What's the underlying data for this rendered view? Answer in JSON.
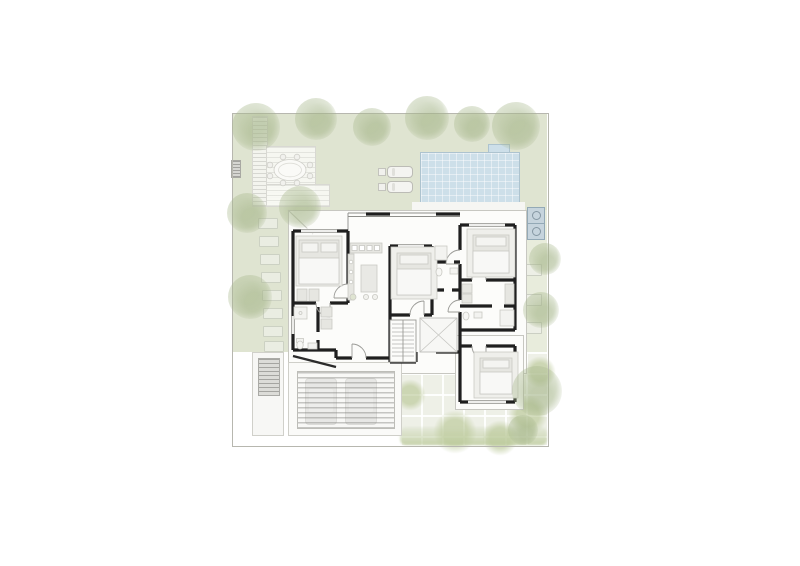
{
  "title": "villa-ground-floor-site-plan",
  "colors": {
    "page-bg": "#ffffff",
    "garden": "#dfe4d1",
    "garden-light": "#e8ecdc",
    "tree": "#a9b98e",
    "pool-fill": "#cddfe9",
    "pool-edge": "#adc3cf",
    "wall": "#1f1f1f",
    "roofline": "#c7c7c1",
    "floor": "#fcfcfa",
    "furniture": "#e6e6e1",
    "furniture-edge": "#c9c9c3",
    "deck": "#f3f4ee",
    "paving": "#eef0e7",
    "grass-patch": "#c9d5ae",
    "car": "#d6d6d2",
    "mat": "#b6b6b2",
    "ac-fill": "#c6d4dd",
    "ac-edge": "#93a9b6",
    "boundary": "#b7b7af",
    "glass": "#8e8e8a",
    "hedge": "#ccd7b6"
  },
  "site": {
    "trees": [
      {
        "x": 256,
        "y": 127,
        "r": 24
      },
      {
        "x": 316,
        "y": 119,
        "r": 21
      },
      {
        "x": 372,
        "y": 127,
        "r": 19
      },
      {
        "x": 427,
        "y": 118,
        "r": 22
      },
      {
        "x": 472,
        "y": 124,
        "r": 18
      },
      {
        "x": 516,
        "y": 126,
        "r": 24
      },
      {
        "x": 247,
        "y": 213,
        "r": 20
      },
      {
        "x": 250,
        "y": 297,
        "r": 22
      },
      {
        "x": 300,
        "y": 207,
        "r": 21
      },
      {
        "x": 545,
        "y": 259,
        "r": 16
      },
      {
        "x": 541,
        "y": 310,
        "r": 18
      },
      {
        "x": 537,
        "y": 391,
        "r": 25
      },
      {
        "x": 523,
        "y": 430,
        "r": 15
      }
    ],
    "left_pavers": [
      {
        "x": 258,
        "y": 218
      },
      {
        "x": 259,
        "y": 236
      },
      {
        "x": 260,
        "y": 254
      },
      {
        "x": 261,
        "y": 272
      },
      {
        "x": 262,
        "y": 290
      },
      {
        "x": 263,
        "y": 308
      },
      {
        "x": 263,
        "y": 326
      },
      {
        "x": 264,
        "y": 341
      }
    ],
    "right_stones": [
      {
        "x": 524,
        "y": 264
      },
      {
        "x": 524,
        "y": 294
      },
      {
        "x": 524,
        "y": 322
      }
    ],
    "grass_patches": [
      {
        "x": 410,
        "y": 395,
        "r": 16
      },
      {
        "x": 455,
        "y": 432,
        "r": 22
      },
      {
        "x": 500,
        "y": 438,
        "r": 18
      },
      {
        "x": 540,
        "y": 372,
        "r": 16
      },
      {
        "x": 528,
        "y": 415,
        "r": 20
      },
      {
        "x": 404,
        "y": 362,
        "r": 10
      }
    ],
    "loungers": [
      {
        "x": 387,
        "y": 166
      },
      {
        "x": 387,
        "y": 181
      }
    ],
    "cars": [
      {
        "x": 16,
        "y": 15
      },
      {
        "x": 56,
        "y": 15
      }
    ],
    "ac_units": [
      {
        "x": 527,
        "y": 207
      },
      {
        "x": 527,
        "y": 223
      }
    ]
  }
}
